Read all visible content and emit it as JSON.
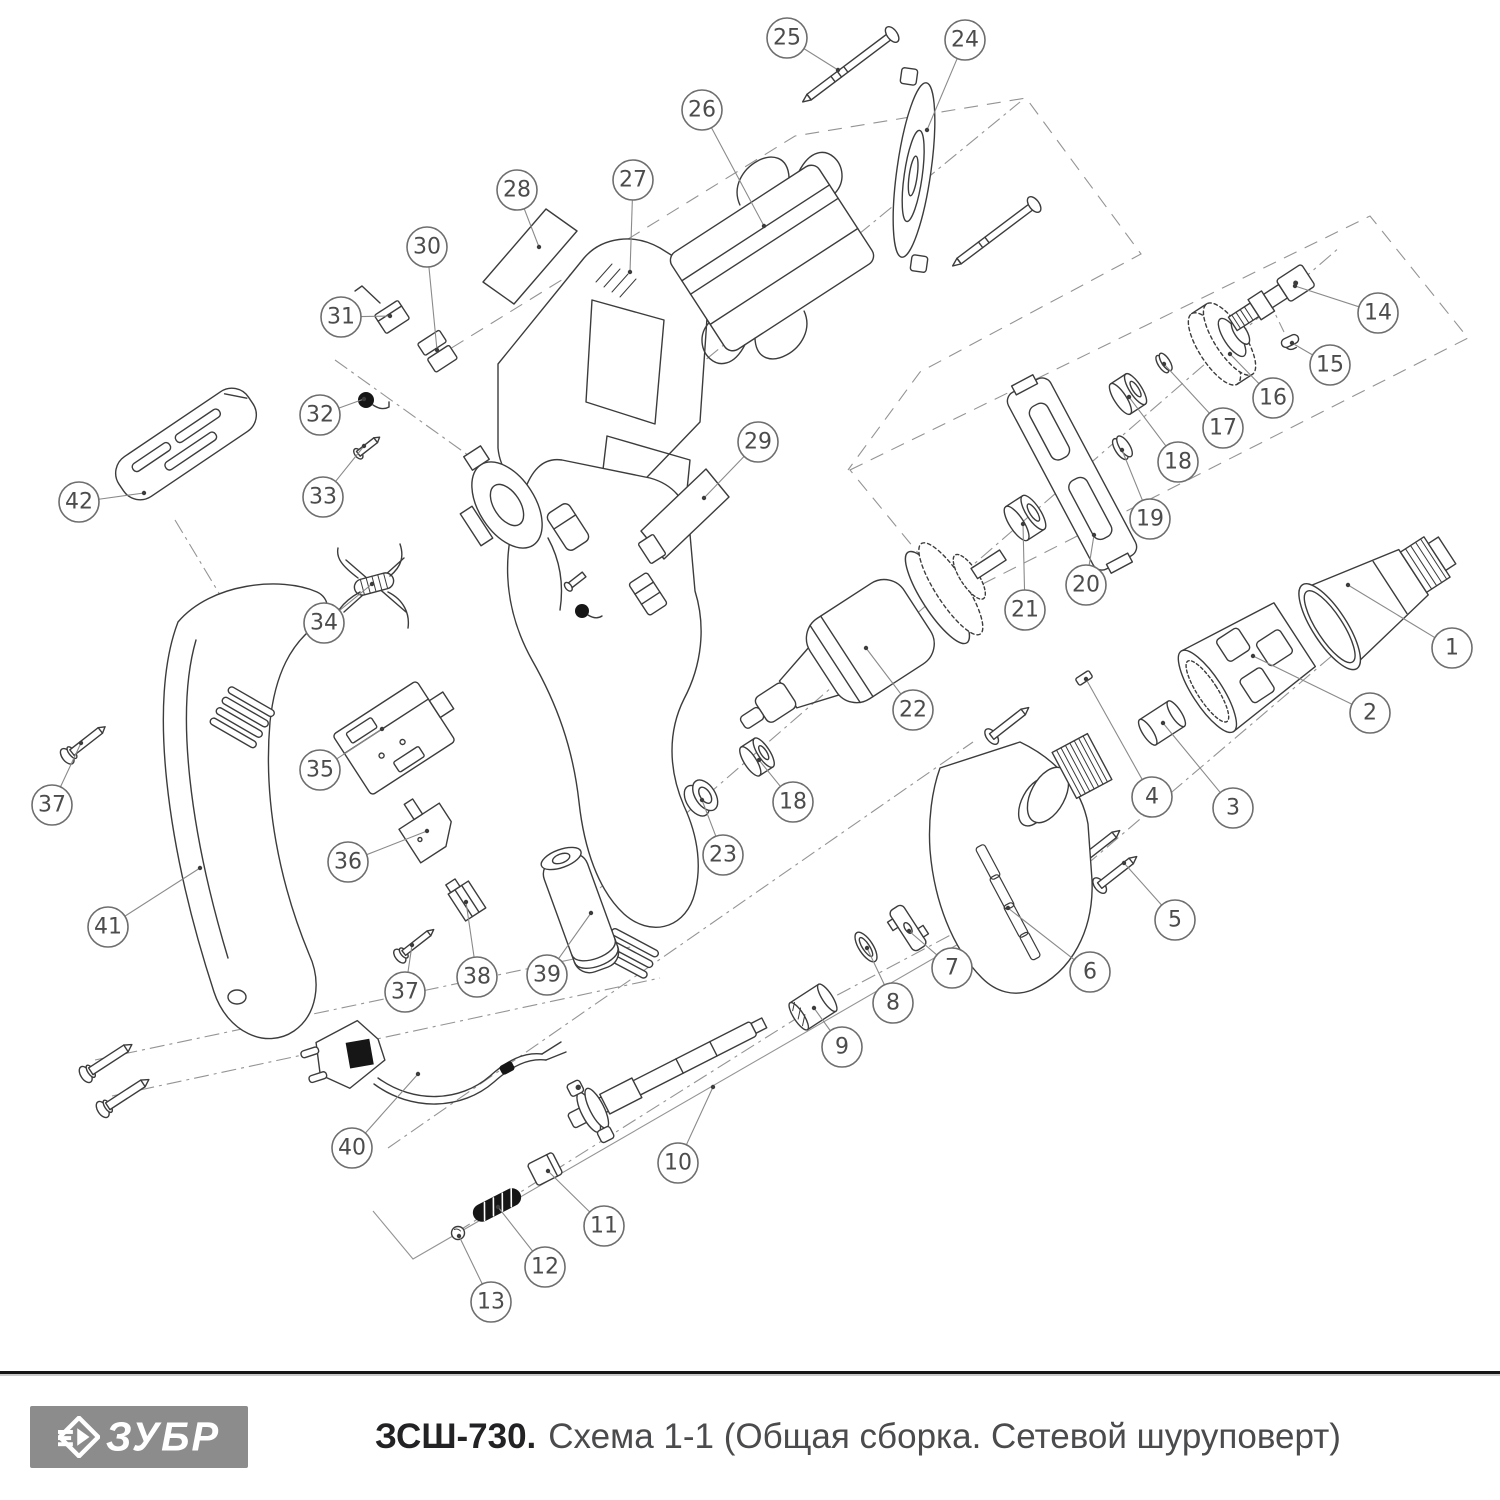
{
  "footer": {
    "brand": "ЗУБР",
    "model": "ЗСШ-730.",
    "subtitle": "Схема 1-1 (Общая сборка. Сетевой шуруповерт)",
    "logo_bg": "#8c8c8c",
    "logo_text_color": "#ffffff",
    "separator_color": "#161616"
  },
  "diagram": {
    "description": "Exploded view of mains-powered screwdriver, schematic 1-1, general assembly",
    "stroke_color": "#3c3c3c",
    "construction_color": "#949494",
    "callout_style": {
      "radius": 20,
      "circle_stroke": "#6e6e6e",
      "leader_stroke": "#8a8a8a",
      "number_color": "#4c4c4c",
      "number_size": 22
    },
    "callouts": [
      {
        "label": "1",
        "cx": 1452,
        "cy": 648,
        "tx": 1348,
        "ty": 585
      },
      {
        "label": "2",
        "cx": 1370,
        "cy": 713,
        "tx": 1253,
        "ty": 656
      },
      {
        "label": "3",
        "cx": 1233,
        "cy": 808,
        "tx": 1163,
        "ty": 723
      },
      {
        "label": "4",
        "cx": 1152,
        "cy": 797,
        "tx": 1086,
        "ty": 679
      },
      {
        "label": "5",
        "cx": 1175,
        "cy": 920,
        "tx": 1124,
        "ty": 863
      },
      {
        "label": "6",
        "cx": 1090,
        "cy": 972,
        "tx": 1008,
        "ty": 908
      },
      {
        "label": "7",
        "cx": 952,
        "cy": 968,
        "tx": 909,
        "ty": 931
      },
      {
        "label": "8",
        "cx": 893,
        "cy": 1003,
        "tx": 867,
        "ty": 948
      },
      {
        "label": "9",
        "cx": 842,
        "cy": 1047,
        "tx": 814,
        "ty": 1008
      },
      {
        "label": "10",
        "cx": 678,
        "cy": 1163,
        "tx": 713,
        "ty": 1087
      },
      {
        "label": "11",
        "cx": 604,
        "cy": 1226,
        "tx": 548,
        "ty": 1171
      },
      {
        "label": "12",
        "cx": 545,
        "cy": 1267,
        "tx": 498,
        "ty": 1207
      },
      {
        "label": "13",
        "cx": 491,
        "cy": 1302,
        "tx": 459,
        "ty": 1236
      },
      {
        "label": "14",
        "cx": 1378,
        "cy": 313,
        "tx": 1295,
        "ty": 286
      },
      {
        "label": "15",
        "cx": 1330,
        "cy": 365,
        "tx": 1292,
        "ty": 343
      },
      {
        "label": "16",
        "cx": 1273,
        "cy": 398,
        "tx": 1230,
        "ty": 354
      },
      {
        "label": "17",
        "cx": 1223,
        "cy": 428,
        "tx": 1164,
        "ty": 364
      },
      {
        "label": "18",
        "cx": 1178,
        "cy": 462,
        "tx": 1129,
        "ty": 397
      },
      {
        "label": "19",
        "cx": 1150,
        "cy": 519,
        "tx": 1122,
        "ty": 450
      },
      {
        "label": "20",
        "cx": 1086,
        "cy": 585,
        "tx": 1094,
        "ty": 535
      },
      {
        "label": "21",
        "cx": 1025,
        "cy": 610,
        "tx": 1023,
        "ty": 524
      },
      {
        "label": "22",
        "cx": 913,
        "cy": 710,
        "tx": 866,
        "ty": 648
      },
      {
        "label": "18",
        "cx": 793,
        "cy": 802,
        "tx": 759,
        "ty": 760
      },
      {
        "label": "23",
        "cx": 723,
        "cy": 855,
        "tx": 702,
        "ty": 800
      },
      {
        "label": "24",
        "cx": 965,
        "cy": 40,
        "tx": 927,
        "ty": 130
      },
      {
        "label": "25",
        "cx": 787,
        "cy": 38,
        "tx": 838,
        "ty": 70
      },
      {
        "label": "26",
        "cx": 702,
        "cy": 110,
        "tx": 764,
        "ty": 226
      },
      {
        "label": "27",
        "cx": 633,
        "cy": 180,
        "tx": 630,
        "ty": 272
      },
      {
        "label": "28",
        "cx": 517,
        "cy": 190,
        "tx": 539,
        "ty": 247
      },
      {
        "label": "29",
        "cx": 758,
        "cy": 442,
        "tx": 704,
        "ty": 498
      },
      {
        "label": "30",
        "cx": 427,
        "cy": 247,
        "tx": 437,
        "ty": 350
      },
      {
        "label": "31",
        "cx": 341,
        "cy": 317,
        "tx": 390,
        "ty": 316
      },
      {
        "label": "32",
        "cx": 320,
        "cy": 415,
        "tx": 364,
        "ty": 399
      },
      {
        "label": "33",
        "cx": 323,
        "cy": 497,
        "tx": 364,
        "ty": 446
      },
      {
        "label": "34",
        "cx": 324,
        "cy": 623,
        "tx": 372,
        "ty": 584
      },
      {
        "label": "35",
        "cx": 320,
        "cy": 770,
        "tx": 382,
        "ty": 729
      },
      {
        "label": "36",
        "cx": 348,
        "cy": 862,
        "tx": 427,
        "ty": 831
      },
      {
        "label": "37",
        "cx": 52,
        "cy": 805,
        "tx": 81,
        "ty": 743
      },
      {
        "label": "38",
        "cx": 477,
        "cy": 977,
        "tx": 466,
        "ty": 902
      },
      {
        "label": "39",
        "cx": 547,
        "cy": 975,
        "tx": 591,
        "ty": 913
      },
      {
        "label": "37",
        "cx": 405,
        "cy": 992,
        "tx": 412,
        "ty": 945
      },
      {
        "label": "40",
        "cx": 352,
        "cy": 1148,
        "tx": 418,
        "ty": 1074
      },
      {
        "label": "41",
        "cx": 108,
        "cy": 927,
        "tx": 200,
        "ty": 868
      },
      {
        "label": "42",
        "cx": 79,
        "cy": 502,
        "tx": 144,
        "ty": 493
      }
    ]
  }
}
